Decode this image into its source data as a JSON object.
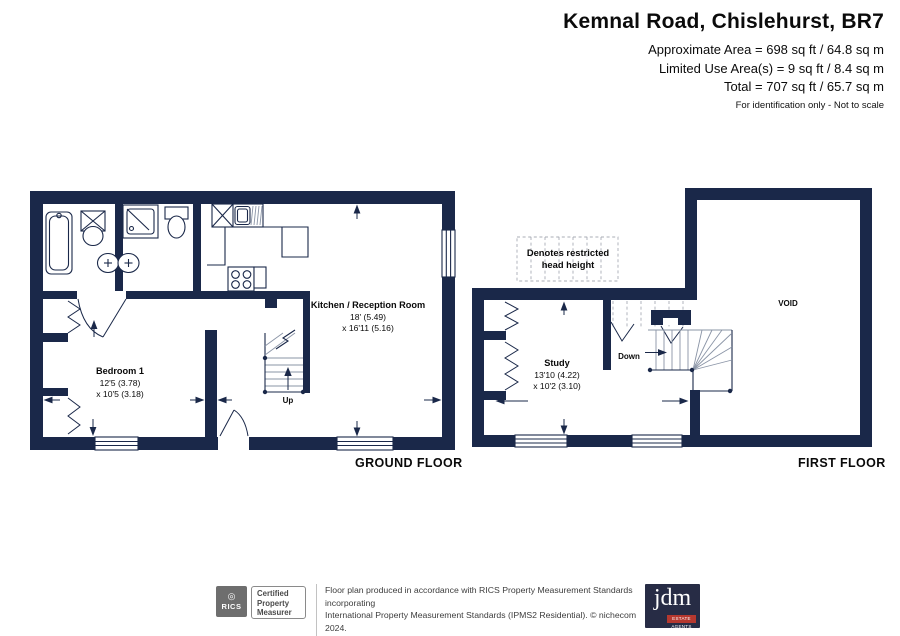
{
  "header": {
    "title": "Kemnal Road, Chislehurst, BR7",
    "area_line1": "Approximate Area = 698 sq ft / 64.8 sq m",
    "area_line2": "Limited Use Area(s) = 9 sq ft / 8.4 sq m",
    "area_line3": "Total = 707 sq ft / 65.7 sq m",
    "disclaimer": "For identification only - Not to scale"
  },
  "floors": {
    "ground_label": "GROUND FLOOR",
    "first_label": "FIRST FLOOR"
  },
  "rooms": {
    "kitchen": {
      "name": "Kitchen /  Reception Room",
      "dim1": "18' (5.49)",
      "dim2": "x 16'11 (5.16)"
    },
    "bedroom1": {
      "name": "Bedroom 1",
      "dim1": "12'5 (3.78)",
      "dim2": "x 10'5 (3.18)"
    },
    "study": {
      "name": "Study",
      "dim1": "13'10 (4.22)",
      "dim2": "x 10'2 (3.10)"
    },
    "void_label": "VOID"
  },
  "stairs": {
    "up_label": "Up",
    "down_label": "Down"
  },
  "legend": {
    "line1": "Denotes restricted",
    "line2": "head height"
  },
  "footer": {
    "rics": {
      "brand": "RICS",
      "badge_line1": "Certified",
      "badge_line2": "Property",
      "badge_line3": "Measurer"
    },
    "note_line1": "Floor plan produced in accordance with RICS Property Measurement Standards incorporating",
    "note_line2": "International Property Measurement Standards (IPMS2 Residential).   © nichecom 2024.",
    "note_line3": "Produced for JDM Estate Agents.   REF: 1092486",
    "jdm": {
      "brand": "jdm",
      "tagline": "ESTATE AGENTS"
    }
  },
  "colors": {
    "wall_navy": "#1a2849",
    "jdm_red": "#b5382f",
    "jdm_navy": "#272c45"
  }
}
